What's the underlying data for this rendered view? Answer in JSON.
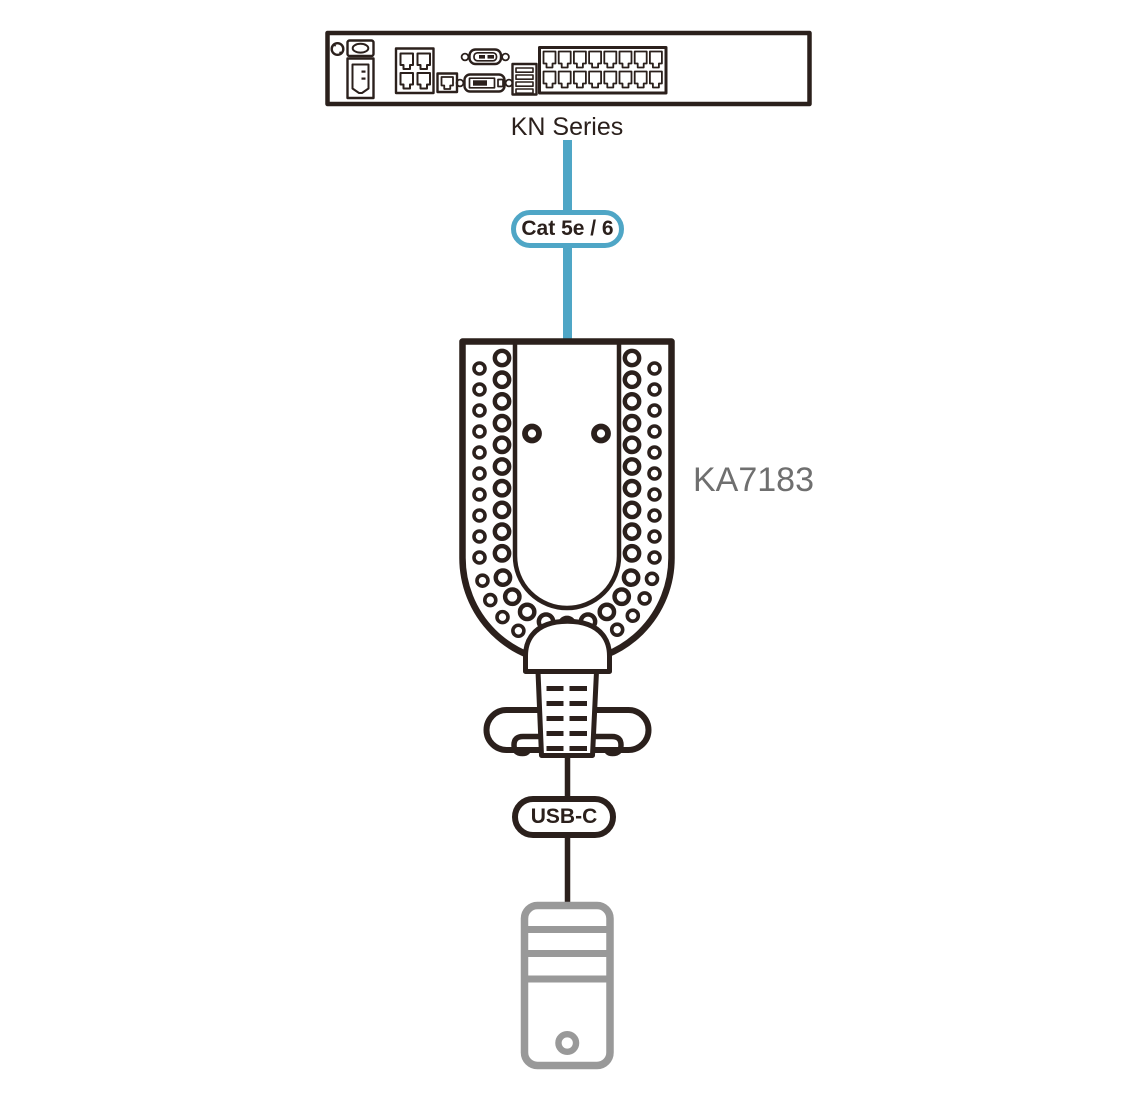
{
  "diagram": {
    "type": "connection-diagram",
    "nodes": [
      {
        "id": "kn-switch",
        "label": "KN Series",
        "kind": "kvm-switch-rear-panel",
        "features": [
          "grounding-terminal",
          "power-switch",
          "power-inlet",
          "lan-port-block",
          "rj45-port",
          "serial-db-port",
          "video-db-port",
          "usb-port-stack",
          "kvm-port-bank-16"
        ]
      },
      {
        "id": "ka7183",
        "label": "KA7183",
        "kind": "kvm-adapter",
        "features": [
          "vent-holes",
          "screw-holes",
          "strain-relief-boot",
          "ribbed-cable-grip",
          "cable-loops"
        ]
      },
      {
        "id": "computer",
        "kind": "computer-tower",
        "features": [
          "drive-bay-lines",
          "power-button"
        ]
      }
    ],
    "edges": [
      {
        "from": "kn-switch",
        "to": "ka7183",
        "label": "Cat 5e / 6",
        "style": "cat5-cable"
      },
      {
        "from": "ka7183",
        "to": "computer",
        "label": "USB-C",
        "style": "usb-cable"
      }
    ]
  },
  "colors": {
    "line": "#2B201C",
    "cable_blue": "#4FA6C6",
    "computer_gray": "#999999",
    "adapter_label": "#6F6F6F",
    "background": "#FFFFFF"
  }
}
